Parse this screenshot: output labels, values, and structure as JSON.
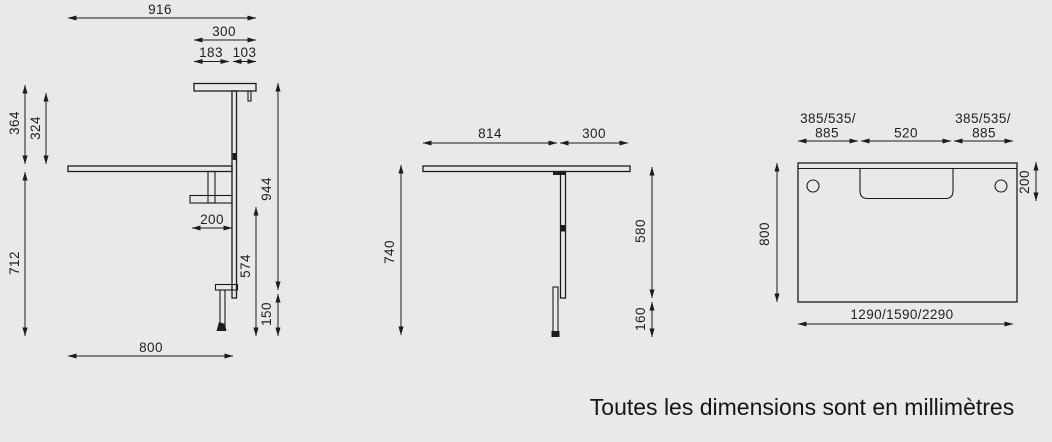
{
  "caption": "Toutes les dimensions sont en millimètres",
  "colors": {
    "background": "#e9e9e7",
    "ink": "#1c1c1c"
  },
  "views": {
    "front": {
      "title": "front-elevation-with-shelf",
      "dims": {
        "w916": "916",
        "w300": "300",
        "w183": "183",
        "w103": "103",
        "h364": "364",
        "h324": "324",
        "h712": "712",
        "h944": "944",
        "w200": "200",
        "h574": "574",
        "h150": "150",
        "w800": "800"
      }
    },
    "side": {
      "title": "side-elevation",
      "dims": {
        "w814": "814",
        "w300": "300",
        "h740": "740",
        "h580": "580",
        "h160": "160"
      }
    },
    "top": {
      "title": "top-plan-view",
      "dims": {
        "left_offsets_line1": "385/535/",
        "left_offsets_line2": "885",
        "center": "520",
        "right_offsets_line1": "385/535/",
        "right_offsets_line2": "885",
        "notch_depth": "200",
        "depth": "800",
        "width_options": "1290/1590/2290"
      }
    }
  }
}
